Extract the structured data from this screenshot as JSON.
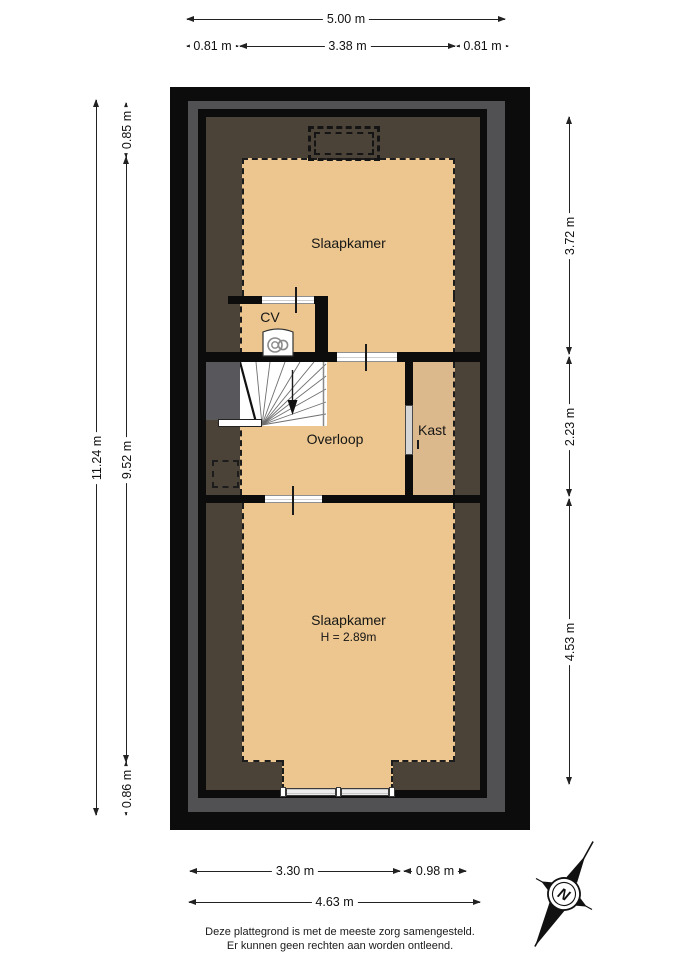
{
  "rooms": {
    "slaapkamer_top": "Slaapkamer",
    "cv": "CV",
    "overloop": "Overloop",
    "kast": "Kast",
    "slaapkamer_bottom": "Slaapkamer",
    "slaapkamer_bottom_height": "H = 2.89m"
  },
  "dims": {
    "top_total": "5.00 m",
    "top_left": "0.81 m",
    "top_mid": "3.38 m",
    "top_right": "0.81 m",
    "left_total": "11.24 m",
    "left_top": "0.85 m",
    "left_mid": "9.52 m",
    "left_bottom": "0.86 m",
    "right_top": "3.72 m",
    "right_mid": "2.23 m",
    "right_bottom": "4.53 m",
    "bottom_left": "3.30 m",
    "bottom_right": "0.98 m",
    "bottom_total": "4.63 m"
  },
  "compass": {
    "north_label": "N"
  },
  "footer": {
    "line1": "Deze plattegrond is met de meeste zorg samengesteld.",
    "line2": "Er kunnen geen rechten aan worden ontleend."
  },
  "theme": {
    "floor-tan": "#ecc68e",
    "floor-tan-dark": "#dcb98c",
    "attic-brown": "#4b4238",
    "wall-black": "#0c0c0c",
    "shell-gray": "#515154",
    "stair-gray": "#58585c",
    "line-color": "#222222",
    "page-bg": "#ffffff"
  }
}
